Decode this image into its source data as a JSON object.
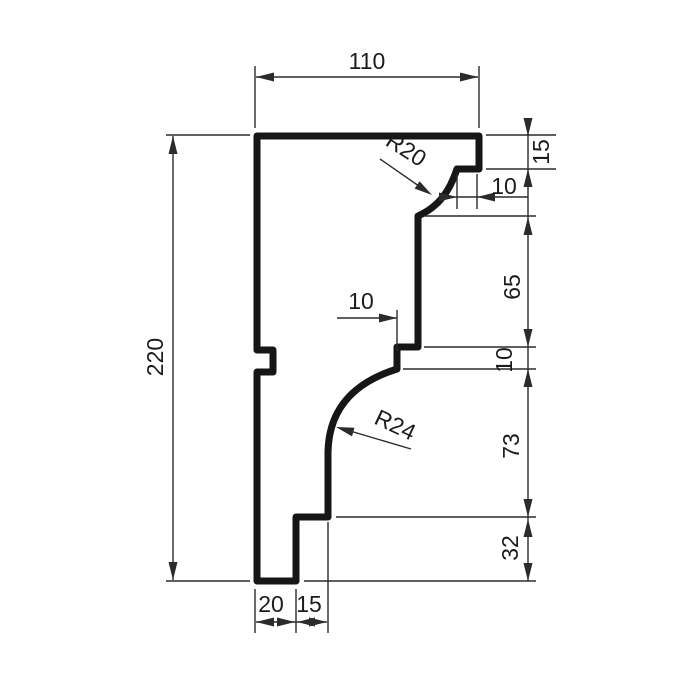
{
  "drawing": {
    "type_hint": "profile-cross-section",
    "dimensions": {
      "top_width": "110",
      "left_height": "220",
      "right_step_height": "15",
      "right_step_depth": "10",
      "right_upper_face": "65",
      "right_small_step": "10",
      "right_lower_face": "73",
      "right_foot_height": "32",
      "mid_step_depth": "10",
      "bottom_left_width": "20",
      "bottom_right_width": "15",
      "radius_top": "R20",
      "radius_bottom": "R24"
    },
    "colors": {
      "outline": "#161616",
      "dimension": "#2b2b2b",
      "text": "#1c1c1c",
      "background": "#ffffff"
    }
  }
}
